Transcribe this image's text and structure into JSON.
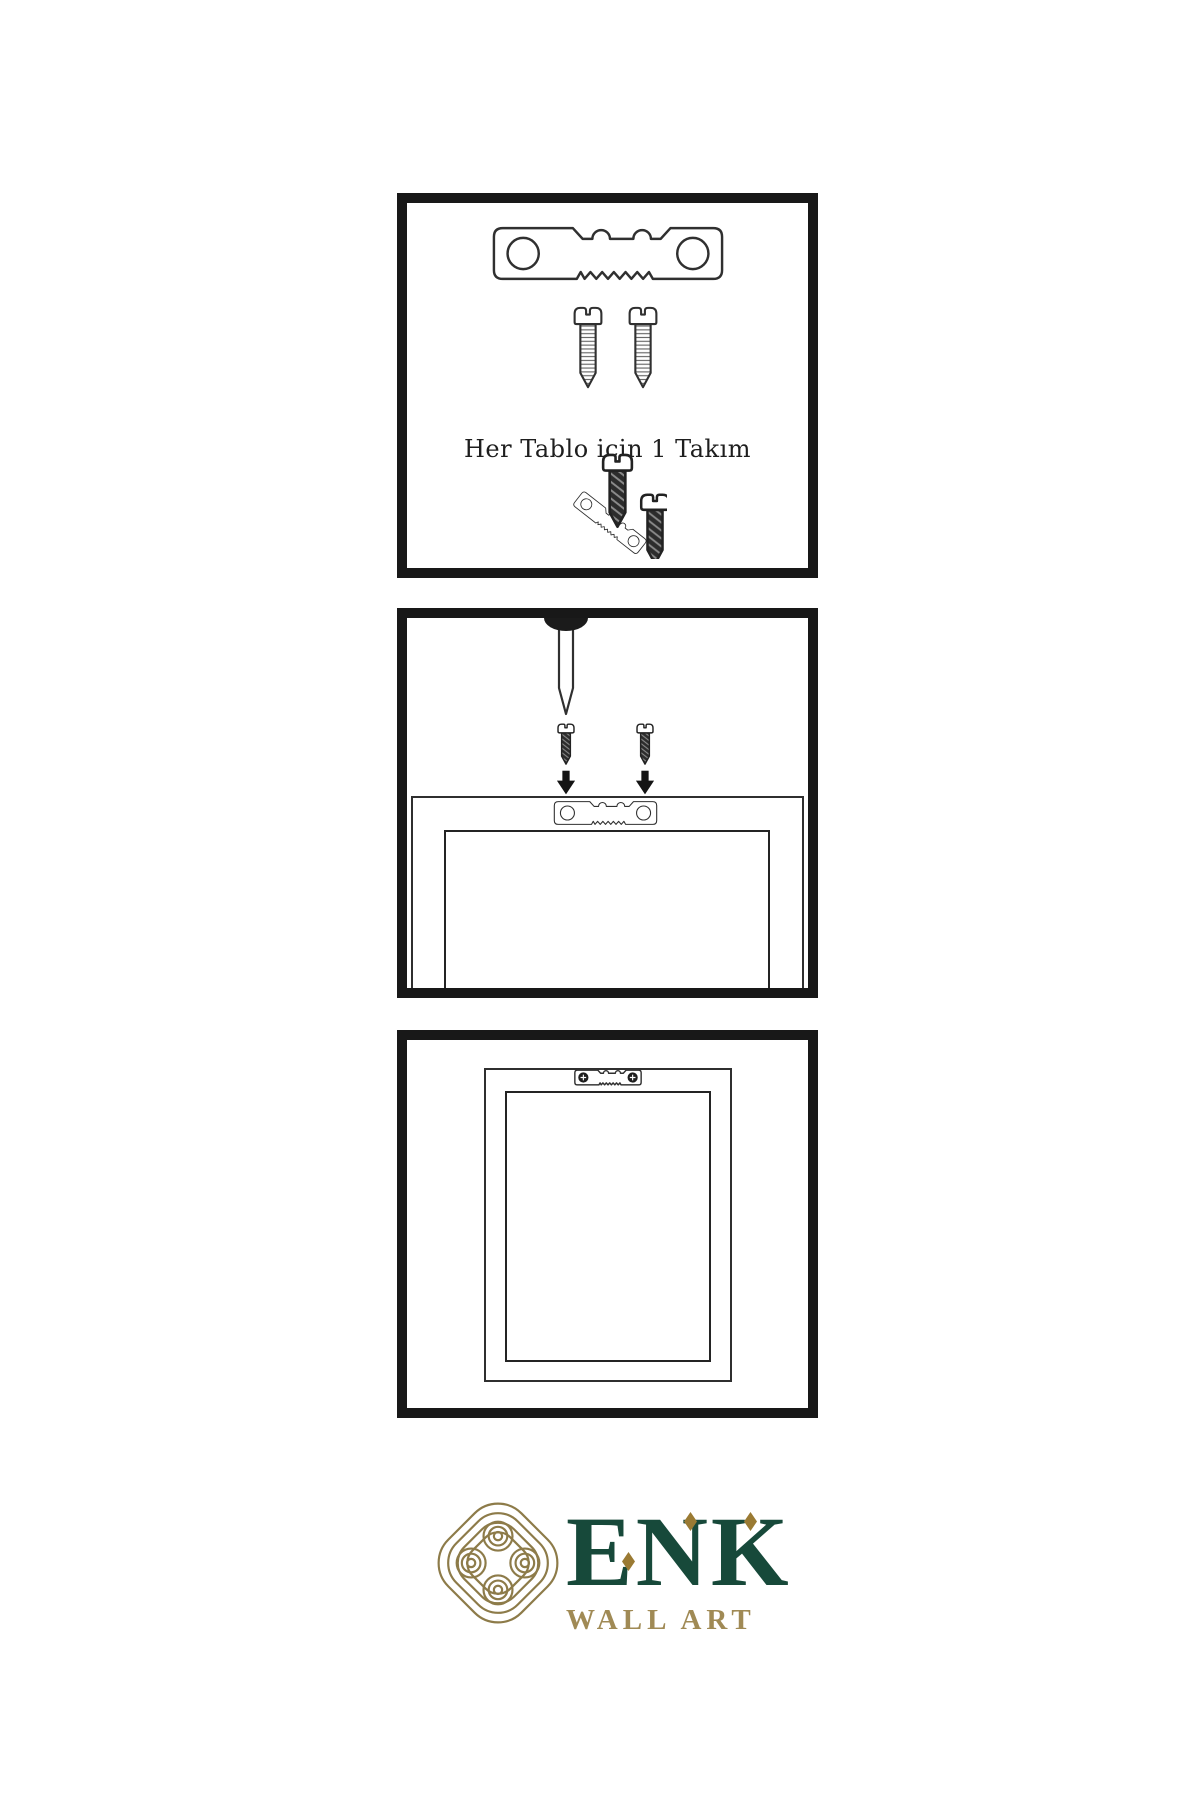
{
  "document": {
    "type": "wall-art-hanging-instructions",
    "background": "#ffffff"
  },
  "panels": {
    "border_color": "#181818",
    "line_color": "#303030",
    "step1": {
      "name": "hanging-kit-contents",
      "instruction_text": "Her Tablo için 1 Takım",
      "illustrations": [
        "sawtooth-hanger-plate",
        "mounting-screw",
        "mounting-screw",
        "angled-hanger-with-screws"
      ]
    },
    "step2": {
      "name": "attach-hanger-to-frame",
      "illustrations": [
        "wall-nail",
        "screw-with-down-arrow",
        "screw-with-down-arrow",
        "frame-back-with-sawtooth-hanger"
      ]
    },
    "step3": {
      "name": "frame-mounted-on-wall",
      "illustrations": [
        "frame-back-with-installed-hanger"
      ]
    }
  },
  "logo": {
    "brand_name": "ENK",
    "brand_subtitle": "WALL ART",
    "brand_name_color": "#17493a",
    "subtitle_color": "#a08a55",
    "knot_color": "#8d7b49",
    "diamond_color": "#9a7a33"
  }
}
